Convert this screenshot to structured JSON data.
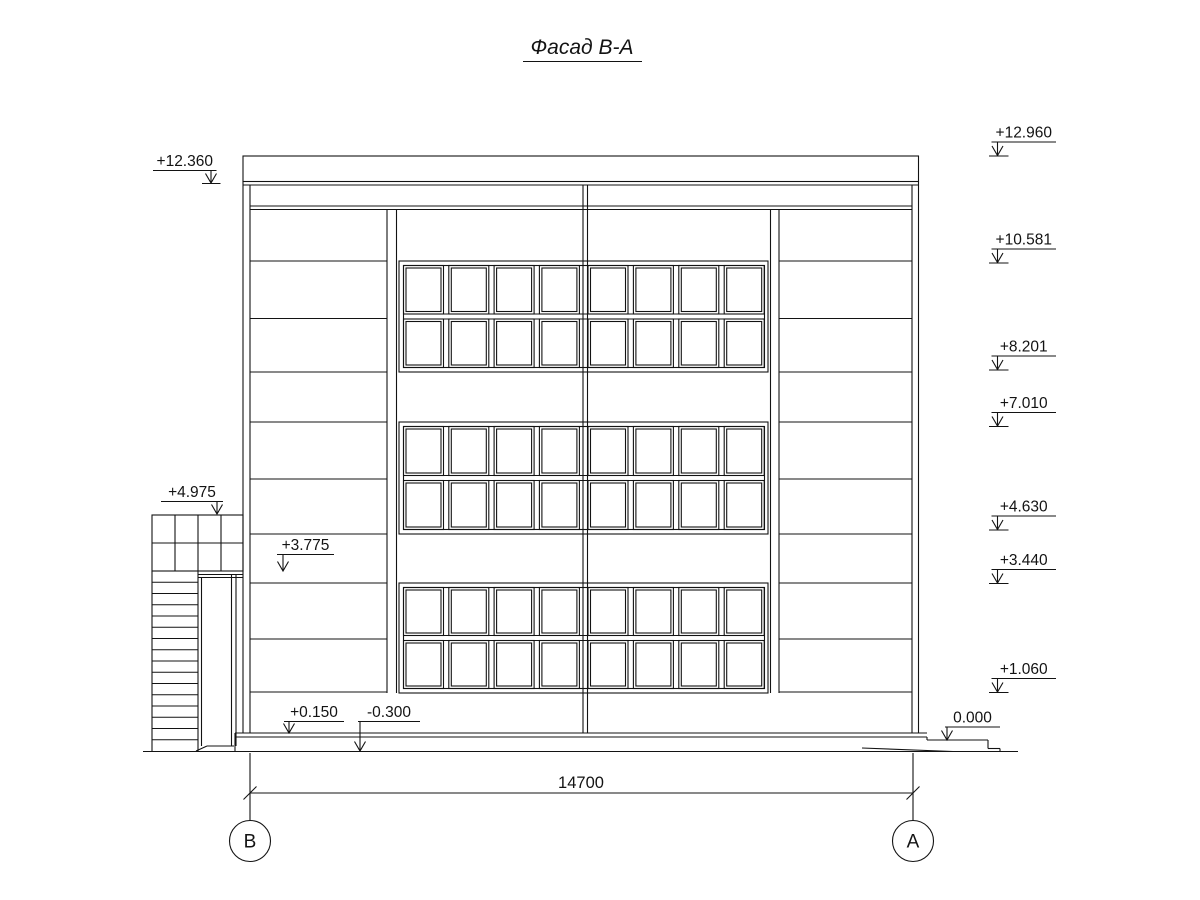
{
  "title": {
    "text": "Фасад В-А"
  },
  "marks": {
    "left": [
      {
        "label": "+12.360"
      },
      {
        "label": "+4.975"
      },
      {
        "label": "+3.775"
      },
      {
        "label": "+0.150"
      },
      {
        "label": "-0.300"
      }
    ],
    "right": [
      {
        "label": "+12.960"
      },
      {
        "label": "+10.581"
      },
      {
        "label": "+8.201"
      },
      {
        "label": "+7.010"
      },
      {
        "label": "+4.630"
      },
      {
        "label": "+3.440"
      },
      {
        "label": "+1.060"
      },
      {
        "label": "0.000"
      }
    ]
  },
  "dimension": {
    "length": "14700"
  },
  "axes": {
    "left": "В",
    "right": "А"
  },
  "colors": {
    "ink": "#131313",
    "paper": "#ffffff"
  }
}
